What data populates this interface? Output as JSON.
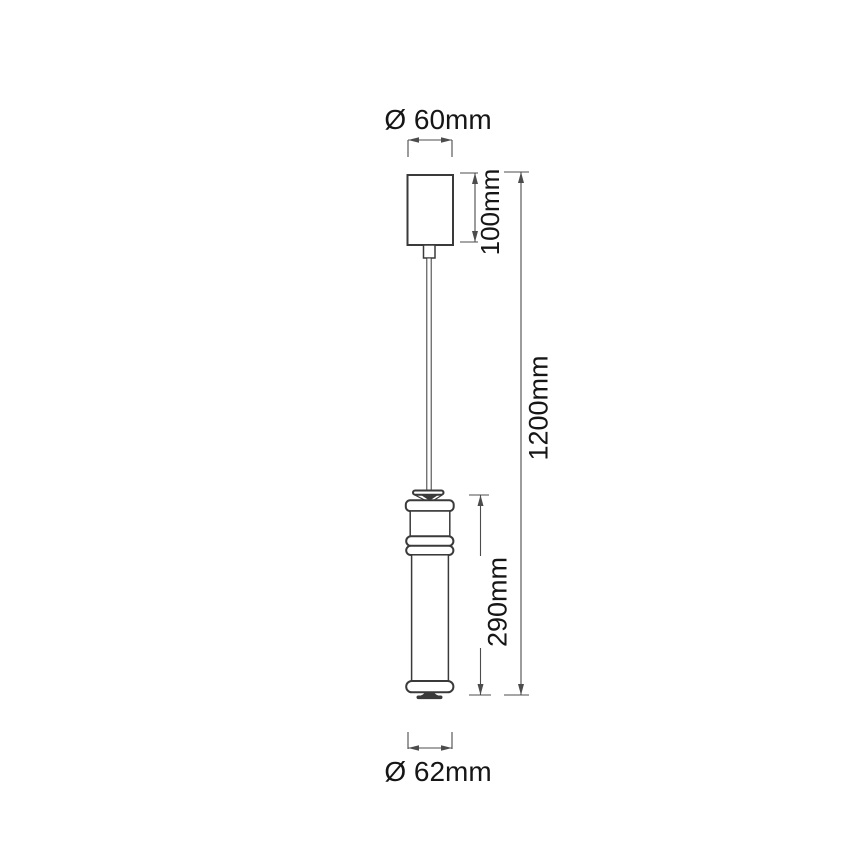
{
  "drawing": {
    "kind": "pendant-light-technical-dimension-drawing",
    "colors": {
      "background": "#ffffff",
      "line": "#3a3a3a",
      "dimension": "#4c4c4c",
      "text": "#161616"
    },
    "labels": {
      "top_diameter": "Ø 60mm",
      "canopy_height": "100mm",
      "overall_length": "1200mm",
      "shade_height": "290mm",
      "bottom_diameter": "Ø 62mm"
    },
    "dimensions_mm": {
      "canopy_diameter": 60,
      "canopy_height": 100,
      "overall_drop": 1200,
      "shade_height": 290,
      "shade_diameter": 62
    }
  }
}
